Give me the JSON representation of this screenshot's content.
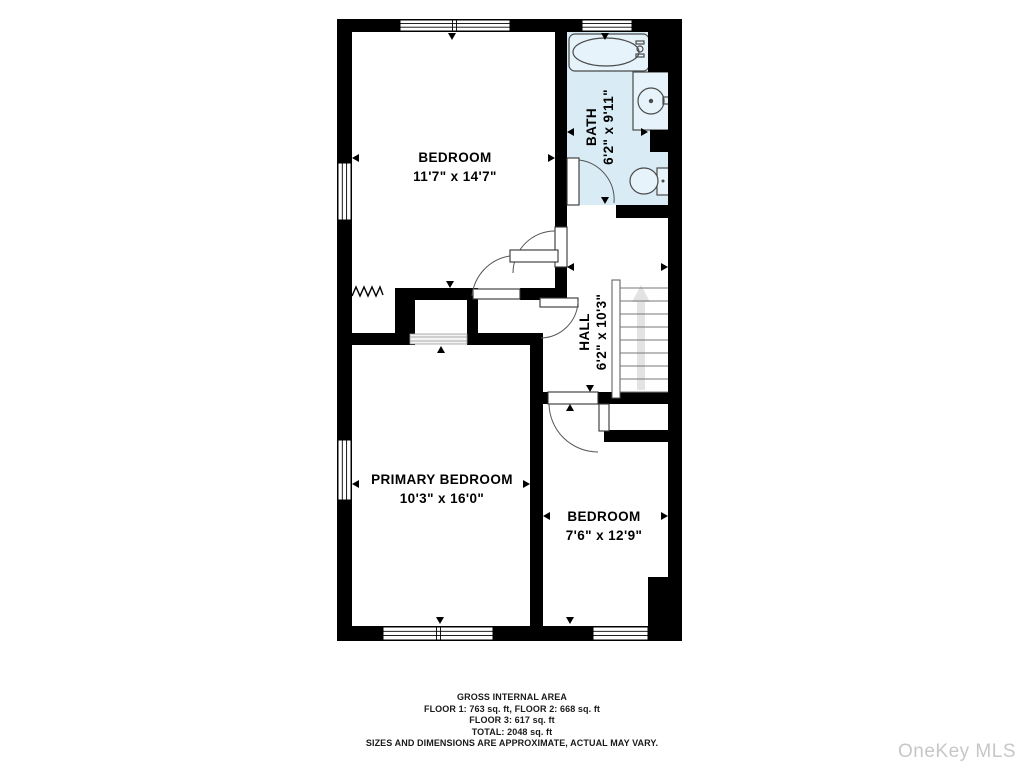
{
  "plan": {
    "rooms": [
      {
        "name": "BEDROOM",
        "dims": "11'7\" x 14'7\""
      },
      {
        "name": "BATH",
        "dims": "6'2\" x 9'11\""
      },
      {
        "name": "HALL",
        "dims": "6'2\" x 10'3\""
      },
      {
        "name": "PRIMARY BEDROOM",
        "dims": "10'3\" x 16'0\""
      },
      {
        "name": "BEDROOM",
        "dims": "7'6\" x 12'9\""
      }
    ],
    "colors": {
      "wall": "#000000",
      "bath_floor": "#d9ecf5",
      "fixture_fill": "#e7f3fa",
      "stair_arrow": "#e3e3e3",
      "watermark_text": "#c7c7c7"
    }
  },
  "footer": {
    "lines": [
      "GROSS INTERNAL AREA",
      "FLOOR 1: 763 sq. ft, FLOOR 2: 668 sq. ft",
      "FLOOR 3: 617 sq. ft",
      "TOTAL: 2048 sq. ft",
      "SIZES AND DIMENSIONS ARE APPROXIMATE, ACTUAL MAY VARY."
    ]
  },
  "watermark": {
    "text": "OneKey MLS"
  }
}
